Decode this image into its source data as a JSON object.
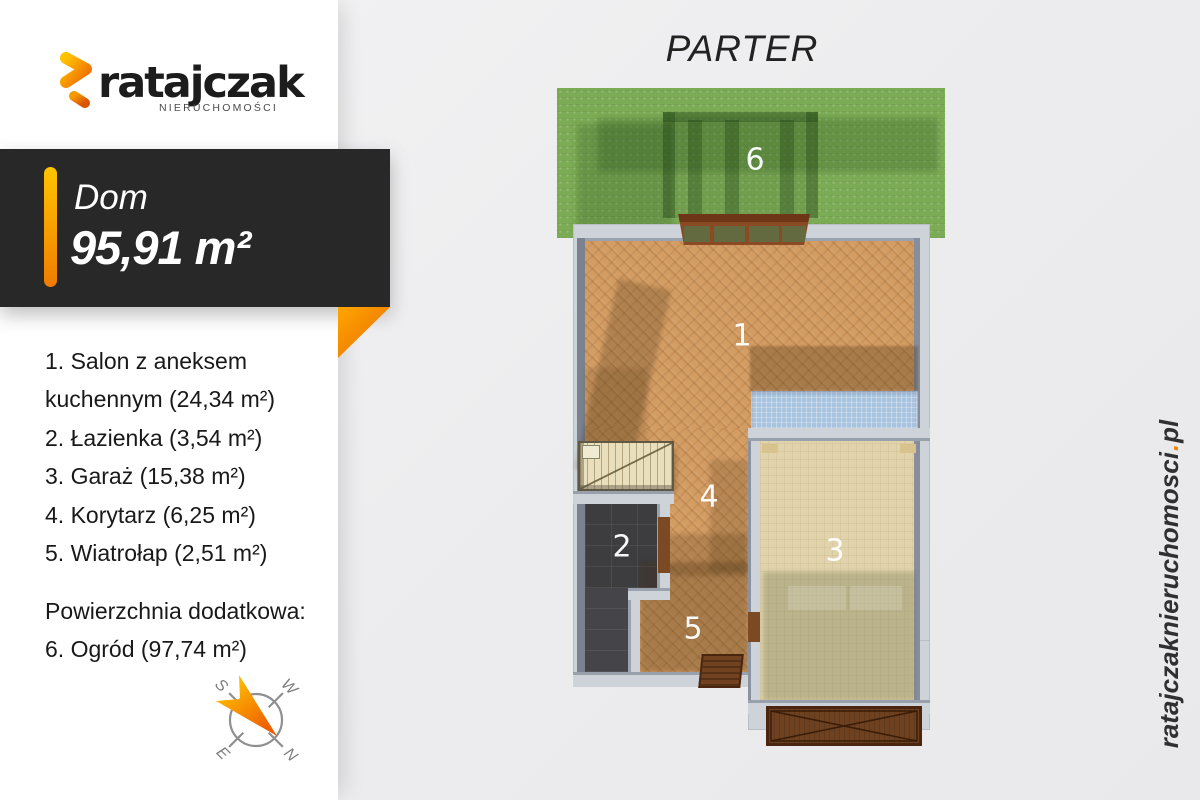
{
  "brand": {
    "name": "ratajczak",
    "subtitle": "NIERUCHOMOŚCI"
  },
  "badge": {
    "property_type": "Dom",
    "area": "95,91 m²"
  },
  "floor_title": "PARTER",
  "legend": {
    "lines": [
      "1. Salon z aneksem",
      "kuchennym (24,34 m²)",
      "2. Łazienka (3,54 m²)",
      "3. Garaż (15,38 m²)",
      "4. Korytarz (6,25 m²)",
      "5. Wiatrołap (2,51 m²)"
    ],
    "extra_title": "Powierzchnia dodatkowa:",
    "extra_item": "6.  Ogród (97,74 m²)"
  },
  "plan": {
    "room_labels": {
      "r1": "1",
      "r2": "2",
      "r3": "3",
      "r4": "4",
      "r5": "5",
      "r6": "6"
    }
  },
  "compass": {
    "letters": {
      "n": "N",
      "e": "E",
      "s": "S",
      "w": "W"
    }
  },
  "watermark": {
    "name": "ratajczaknieruchomosci",
    "dot": ".",
    "tld": "pl"
  },
  "colors": {
    "accent_orange": "#f08300",
    "badge_bg": "#282828",
    "garden_green": "#7cab55",
    "wood_floor": "#d39c63",
    "garage_floor": "#e1d3ab",
    "counter_blue": "#a9c4de",
    "bath_dark": "#3d3c3f",
    "wall_gray": "#ced3da"
  }
}
